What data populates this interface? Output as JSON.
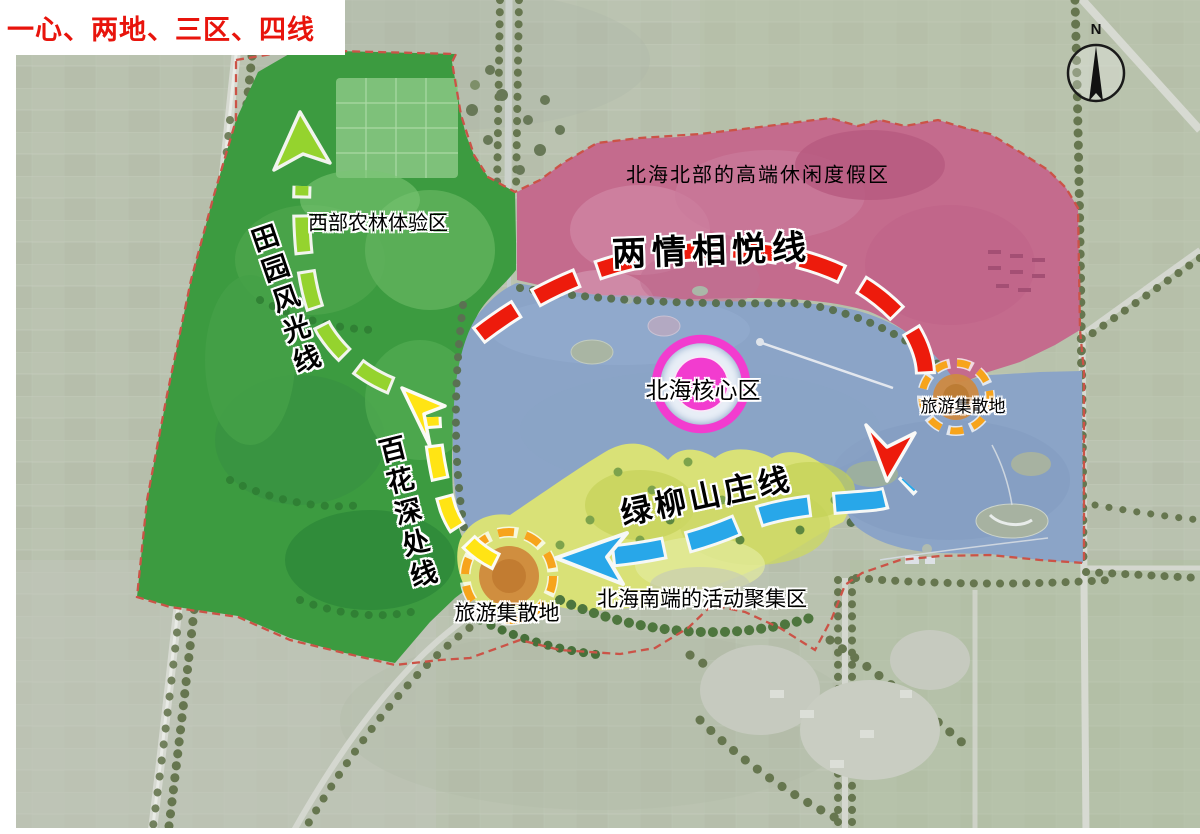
{
  "title": {
    "text": "一心、两地、三区、四线",
    "color": "#e8140c"
  },
  "compass": {
    "label": "N"
  },
  "map": {
    "zones": {
      "west_farm_forest": {
        "label": "西部农林体验区",
        "color": "#3c9b40"
      },
      "north_resort": {
        "label": "北海北部的高端休闲度假区",
        "color": "#c46b8d"
      },
      "south_activity": {
        "label": "北海南端的活动聚集区",
        "color": "#d9e177"
      },
      "core": {
        "label": "北海核心区",
        "color": "#f23ccf"
      },
      "lake_color": "#8ba4c7"
    },
    "routes": {
      "pastoral": {
        "label": "田园风光线",
        "color": "#95d32e"
      },
      "love": {
        "label": "两情相悦线",
        "color": "#ed1b0c"
      },
      "flowers": {
        "label": "百花深处线",
        "color": "#ffe414"
      },
      "villa": {
        "label": "绿柳山庄线",
        "color": "#28a7e9"
      }
    },
    "hubs": {
      "west": {
        "label": "旅游集散地"
      },
      "east": {
        "label": "旅游集散地"
      },
      "ring_color": "#f7a41c"
    },
    "boundary_color": "#cb5347"
  }
}
